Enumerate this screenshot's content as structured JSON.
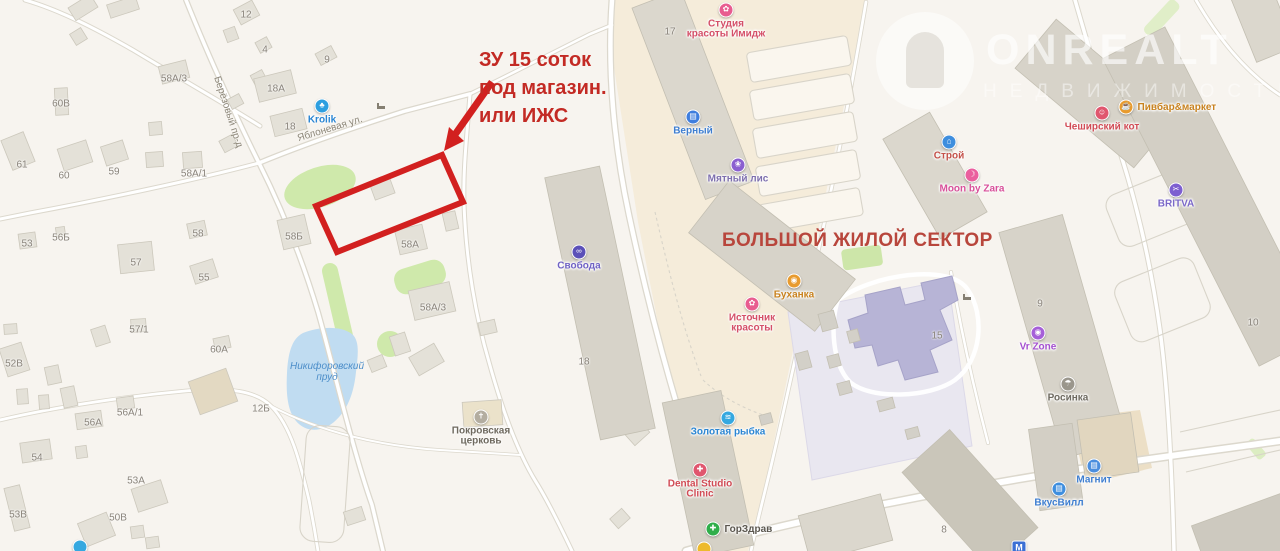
{
  "annotations": {
    "plot_note": {
      "lines": [
        "ЗУ 15 соток",
        "под магазин.",
        "или ИЖС"
      ],
      "color": "#c32a24"
    },
    "sector_note": "БОЛЬШОЙ ЖИЛОЙ СЕКТОР",
    "highlight_color": "#d2201f"
  },
  "watermark": {
    "brand": "ONREALT",
    "tagline": "НЕДВИЖИМОСТЬ"
  },
  "streets": [
    {
      "id": "berezovy-proezd",
      "name": "Берёзовый пр-д",
      "x": 228,
      "y": 112,
      "rot": 72
    },
    {
      "id": "yablonevaya-ulitsa",
      "name": "Яблоневая ул.",
      "x": 330,
      "y": 129,
      "rot": -17
    }
  ],
  "water_labels": [
    {
      "id": "nikiforovsky-prud",
      "lines": [
        "Никифоровский",
        "пруд"
      ],
      "x": 327,
      "y": 372
    }
  ],
  "house_numbers": [
    {
      "t": "12",
      "x": 246,
      "y": 15
    },
    {
      "t": "4",
      "x": 265,
      "y": 50
    },
    {
      "t": "9",
      "x": 327,
      "y": 60
    },
    {
      "t": "18А",
      "x": 276,
      "y": 89
    },
    {
      "t": "18",
      "x": 290,
      "y": 127
    },
    {
      "t": "58А/3",
      "x": 174,
      "y": 79
    },
    {
      "t": "60В",
      "x": 61,
      "y": 104
    },
    {
      "t": "61",
      "x": 22,
      "y": 165
    },
    {
      "t": "60",
      "x": 64,
      "y": 176
    },
    {
      "t": "59",
      "x": 114,
      "y": 172
    },
    {
      "t": "58А/1",
      "x": 194,
      "y": 174
    },
    {
      "t": "53",
      "x": 27,
      "y": 244
    },
    {
      "t": "56Б",
      "x": 61,
      "y": 238
    },
    {
      "t": "57",
      "x": 136,
      "y": 263
    },
    {
      "t": "58",
      "x": 198,
      "y": 234
    },
    {
      "t": "55",
      "x": 204,
      "y": 278
    },
    {
      "t": "57/1",
      "x": 139,
      "y": 330
    },
    {
      "t": "60А",
      "x": 219,
      "y": 350
    },
    {
      "t": "52В",
      "x": 14,
      "y": 364
    },
    {
      "t": "58Б",
      "x": 294,
      "y": 237
    },
    {
      "t": "58А",
      "x": 410,
      "y": 245
    },
    {
      "t": "58А/3",
      "x": 433,
      "y": 308
    },
    {
      "t": "12Б",
      "x": 261,
      "y": 409
    },
    {
      "t": "56А/1",
      "x": 130,
      "y": 413
    },
    {
      "t": "56А",
      "x": 93,
      "y": 423
    },
    {
      "t": "54",
      "x": 37,
      "y": 458
    },
    {
      "t": "53А",
      "x": 136,
      "y": 481
    },
    {
      "t": "53В",
      "x": 18,
      "y": 515
    },
    {
      "t": "50В",
      "x": 118,
      "y": 518
    },
    {
      "t": "17",
      "x": 670,
      "y": 32
    },
    {
      "t": "18",
      "x": 584,
      "y": 362
    },
    {
      "t": "15",
      "x": 937,
      "y": 336
    },
    {
      "t": "9",
      "x": 1040,
      "y": 304
    },
    {
      "t": "10",
      "x": 1253,
      "y": 323
    },
    {
      "t": "8",
      "x": 944,
      "y": 530
    }
  ],
  "pois": [
    {
      "id": "krolik",
      "x": 322,
      "y": 106,
      "glyph": "♣",
      "icon_color": "#2d9fe0",
      "text_color": "#2b86d3",
      "lines": [
        "Krolik"
      ],
      "side": "below"
    },
    {
      "id": "studiya-krasoty-imidzh",
      "x": 726,
      "y": 10,
      "glyph": "✿",
      "icon_color": "#e85c8f",
      "text_color": "#d44f68",
      "lines": [
        "Студия",
        "красоты Имидж"
      ],
      "side": "below"
    },
    {
      "id": "verny",
      "x": 693,
      "y": 117,
      "glyph": "▤",
      "icon_color": "#3e7ede",
      "text_color": "#3e7ed0",
      "lines": [
        "Верный"
      ],
      "side": "below"
    },
    {
      "id": "myatny-lis",
      "x": 738,
      "y": 165,
      "glyph": "❀",
      "icon_color": "#8a5fd0",
      "text_color": "#7d6fae",
      "lines": [
        "Мятный лис"
      ],
      "side": "below"
    },
    {
      "id": "pivbar-market",
      "x": 1126,
      "y": 107,
      "glyph": "☕",
      "icon_color": "#e89b2e",
      "text_color": "#c8821f",
      "lines": [
        "Пивбар&маркет"
      ],
      "side": "right"
    },
    {
      "id": "cheshirsky-kot",
      "x": 1102,
      "y": 113,
      "glyph": "☺",
      "icon_color": "#e0566e",
      "text_color": "#d14b55",
      "lines": [
        "Чеширский кот"
      ],
      "side": "below"
    },
    {
      "id": "stroy",
      "x": 949,
      "y": 142,
      "glyph": "⌂",
      "icon_color": "#3e8ede",
      "text_color": "#c4524a",
      "lines": [
        "Строй"
      ],
      "side": "below"
    },
    {
      "id": "moon-by-zara",
      "x": 972,
      "y": 175,
      "glyph": "☽",
      "icon_color": "#ea5f9e",
      "text_color": "#d8509a",
      "lines": [
        "Moon by Zara"
      ],
      "side": "below"
    },
    {
      "id": "britva",
      "x": 1176,
      "y": 190,
      "glyph": "✂",
      "icon_color": "#7d5fd0",
      "text_color": "#7b68c8",
      "lines": [
        "BRITVA"
      ],
      "side": "below"
    },
    {
      "id": "svoboda",
      "x": 579,
      "y": 252,
      "glyph": "∞",
      "icon_color": "#5b50b8",
      "text_color": "#6f62c4",
      "lines": [
        "Свобода"
      ],
      "side": "below"
    },
    {
      "id": "bukhanka",
      "x": 794,
      "y": 281,
      "glyph": "◉",
      "icon_color": "#e89b2e",
      "text_color": "#c8821f",
      "lines": [
        "Буханка"
      ],
      "side": "below"
    },
    {
      "id": "istochnik-krasoty",
      "x": 752,
      "y": 304,
      "glyph": "✿",
      "icon_color": "#e85c8f",
      "text_color": "#d44f68",
      "lines": [
        "Источник",
        "красоты"
      ],
      "side": "below"
    },
    {
      "id": "zolotaya-rybka",
      "x": 728,
      "y": 418,
      "glyph": "≋",
      "icon_color": "#35a8e0",
      "text_color": "#2b86d3",
      "lines": [
        "Золотая рыбка"
      ],
      "side": "below"
    },
    {
      "id": "dental-studio-clinic",
      "x": 700,
      "y": 470,
      "glyph": "✚",
      "icon_color": "#e0566e",
      "text_color": "#d14b55",
      "lines": [
        "Dental Studio",
        "Clinic"
      ],
      "side": "below"
    },
    {
      "id": "gorzdrav",
      "x": 713,
      "y": 529,
      "glyph": "✚",
      "icon_color": "#2fae4a",
      "text_color": "#5a564e",
      "lines": [
        "ГорЗдрав"
      ],
      "side": "right"
    },
    {
      "id": "vr-zone",
      "x": 1038,
      "y": 333,
      "glyph": "◉",
      "icon_color": "#a55fd8",
      "text_color": "#a44fd0",
      "lines": [
        "Vr Zone"
      ],
      "side": "below"
    },
    {
      "id": "rosinka",
      "x": 1068,
      "y": 384,
      "glyph": "☂",
      "icon_color": "#9a968c",
      "text_color": "#6e6a60",
      "lines": [
        "Росинка"
      ],
      "side": "below"
    },
    {
      "id": "magnit",
      "x": 1094,
      "y": 466,
      "glyph": "▤",
      "icon_color": "#4a8ede",
      "text_color": "#3e7ed0",
      "lines": [
        "Магнит"
      ],
      "side": "below"
    },
    {
      "id": "vkusvill",
      "x": 1059,
      "y": 489,
      "glyph": "▤",
      "icon_color": "#3e8ede",
      "text_color": "#3e7ed0",
      "lines": [
        "ВкусВилл"
      ],
      "side": "below"
    },
    {
      "id": "pokrovskaya-tserkov",
      "x": 481,
      "y": 417,
      "glyph": "✝",
      "icon_color": "#b3ada0",
      "text_color": "#6e695e",
      "lines": [
        "Покровская",
        "церковь"
      ],
      "side": "below"
    },
    {
      "id": "poi-bottom-left",
      "x": 80,
      "y": 547,
      "glyph": "",
      "icon_color": "#35a8e0",
      "text_color": "#2b86d3",
      "lines": [],
      "side": "below"
    },
    {
      "id": "poi-yellow-bottom",
      "x": 704,
      "y": 549,
      "glyph": "",
      "icon_color": "#edba2c",
      "text_color": "#8a8478",
      "lines": [],
      "side": "below"
    },
    {
      "id": "transit-stop",
      "x": 1019,
      "y": 548,
      "glyph": "M",
      "icon_color": "#3b6fd4",
      "text_color": "#3b6fd4",
      "lines": [],
      "side": "below",
      "shape": "square"
    }
  ]
}
